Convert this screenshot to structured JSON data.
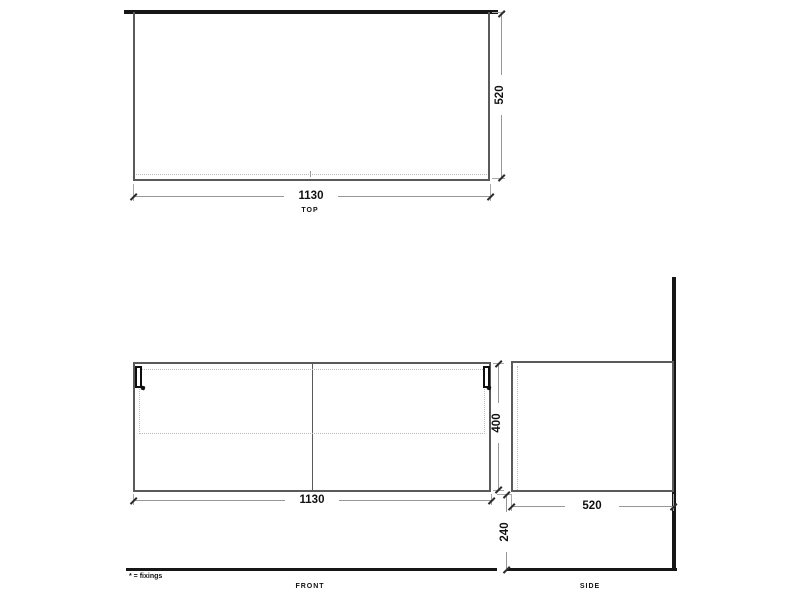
{
  "note": "* = fixings",
  "views": {
    "top": {
      "label": "TOP",
      "width": "1130",
      "depth": "520"
    },
    "front": {
      "label": "FRONT",
      "width": "1130",
      "height": "400"
    },
    "side": {
      "label": "SIDE",
      "depth": "520",
      "height_from_floor": "240"
    }
  },
  "colors": {
    "heavy_line": "#161616",
    "outline": "#5a5a5a",
    "dimension_line": "#979797",
    "hidden_line": "#b9b9b9",
    "text": "#111111",
    "background": "#ffffff"
  }
}
